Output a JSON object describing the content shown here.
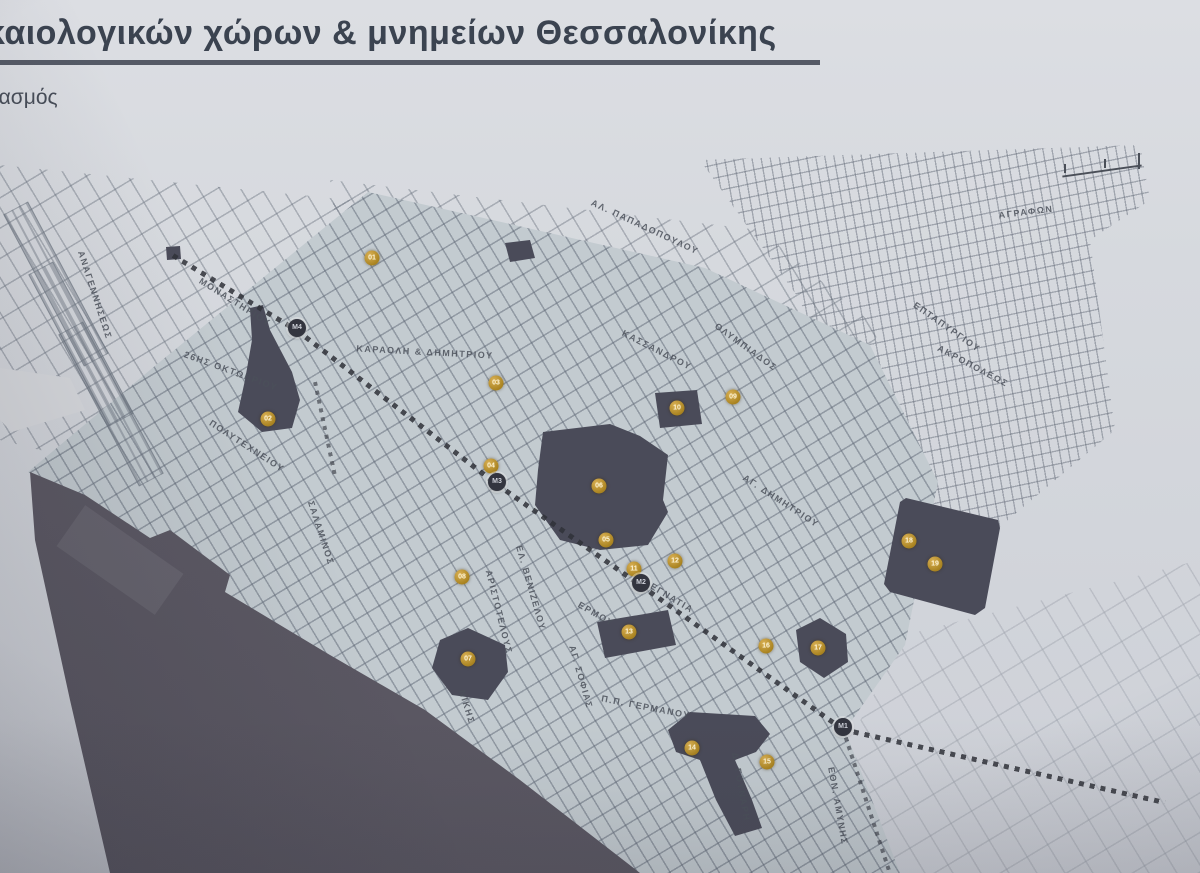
{
  "slide": {
    "title": "καιολογικών χώρων & μνημείων Θεσσαλονίκης",
    "subtitle": "ιασμός"
  },
  "map": {
    "colors": {
      "marker_gold": "#b8922e",
      "metro_dark": "#33353f",
      "site_dark": "#4a4b59",
      "sea_gray": "#5e5b66",
      "paper": "#d6d9de"
    },
    "markers": [
      {
        "id": "01",
        "x": 372,
        "y": 118
      },
      {
        "id": "02",
        "x": 268,
        "y": 279
      },
      {
        "id": "03",
        "x": 496,
        "y": 243
      },
      {
        "id": "04",
        "x": 491,
        "y": 326
      },
      {
        "id": "05",
        "x": 606,
        "y": 400
      },
      {
        "id": "06",
        "x": 599,
        "y": 346
      },
      {
        "id": "07",
        "x": 468,
        "y": 519
      },
      {
        "id": "08",
        "x": 462,
        "y": 437
      },
      {
        "id": "09",
        "x": 733,
        "y": 257
      },
      {
        "id": "10",
        "x": 677,
        "y": 268
      },
      {
        "id": "11",
        "x": 634,
        "y": 429
      },
      {
        "id": "12",
        "x": 675,
        "y": 421
      },
      {
        "id": "13",
        "x": 629,
        "y": 492
      },
      {
        "id": "14",
        "x": 692,
        "y": 608
      },
      {
        "id": "15",
        "x": 767,
        "y": 622
      },
      {
        "id": "16",
        "x": 766,
        "y": 506
      },
      {
        "id": "17",
        "x": 818,
        "y": 508
      },
      {
        "id": "18",
        "x": 909,
        "y": 401
      },
      {
        "id": "19",
        "x": 935,
        "y": 424
      }
    ],
    "metro_stations": [
      {
        "label": "M4",
        "x": 297,
        "y": 188
      },
      {
        "label": "M3",
        "x": 497,
        "y": 342
      },
      {
        "label": "M2",
        "x": 641,
        "y": 443
      },
      {
        "label": "M1",
        "x": 843,
        "y": 587
      }
    ],
    "street_labels": [
      {
        "text": "ΑΝΑΓΕΝΝΗΣΕΩΣ",
        "x": 95,
        "y": 155,
        "angle": 72
      },
      {
        "text": "ΜΟΝΑΣΤΗΡΙΟΥ",
        "x": 235,
        "y": 162,
        "angle": 32
      },
      {
        "text": "26ΗΣ ΟΚΤΩΒΡΙΟΥ",
        "x": 231,
        "y": 231,
        "angle": 20
      },
      {
        "text": "ΠΟΛΥΤΕΧΝΕΙΟΥ",
        "x": 247,
        "y": 306,
        "angle": 33
      },
      {
        "text": "ΣΑΛΑΜΙΝΟΣ",
        "x": 321,
        "y": 393,
        "angle": 72
      },
      {
        "text": "ΚΑΡΑΟΛΗ & ΔΗΜΗΤΡΙΟΥ",
        "x": 425,
        "y": 212,
        "angle": 3
      },
      {
        "text": "ΚΑΣΣΑΝΔΡΟΥ",
        "x": 657,
        "y": 210,
        "angle": 27
      },
      {
        "text": "ΟΛΥΜΠΙΑΔΟΣ",
        "x": 746,
        "y": 207,
        "angle": 36
      },
      {
        "text": "ΑΛ. ΠΑΠΑΔΟΠΟΥΛΟΥ",
        "x": 645,
        "y": 87,
        "angle": 25
      },
      {
        "text": "ΕΠΤΑΠΥΡΓΙΟΥ",
        "x": 947,
        "y": 187,
        "angle": 35
      },
      {
        "text": "ΑΚΡΟΠΟΛΕΩΣ",
        "x": 973,
        "y": 226,
        "angle": 28
      },
      {
        "text": "ΑΓΡΑΦΩΝ",
        "x": 1026,
        "y": 72,
        "angle": -7
      },
      {
        "text": "ΑΓ. ΔΗΜΗΤΡΙΟΥ",
        "x": 781,
        "y": 361,
        "angle": 33
      },
      {
        "text": "ΕΓΝΑΤΙΑ",
        "x": 672,
        "y": 458,
        "angle": 31
      },
      {
        "text": "ΑΡΙΣΤΟΤΕΛΟΥΣ",
        "x": 499,
        "y": 472,
        "angle": 76
      },
      {
        "text": "ΕΛ. ΒΕΝΙΖΕΛΟΥ",
        "x": 531,
        "y": 448,
        "angle": 74
      },
      {
        "text": "ΕΡΜΟΥ",
        "x": 596,
        "y": 474,
        "angle": 30
      },
      {
        "text": "Π.Π. ΓΕΡΜΑΝΟΥ",
        "x": 646,
        "y": 567,
        "angle": 11
      },
      {
        "text": "ΑΓ. ΣΟΦΙΑΣ",
        "x": 581,
        "y": 537,
        "angle": 74
      },
      {
        "text": "Δ. ΓΟΥΝΑΡΗ",
        "x": 741,
        "y": 647,
        "angle": 80
      },
      {
        "text": "ΝΙΚΗΣ",
        "x": 467,
        "y": 567,
        "angle": 73
      },
      {
        "text": "ΕΘΝ. ΑΜΥΝΗΣ",
        "x": 838,
        "y": 666,
        "angle": 80
      }
    ]
  }
}
